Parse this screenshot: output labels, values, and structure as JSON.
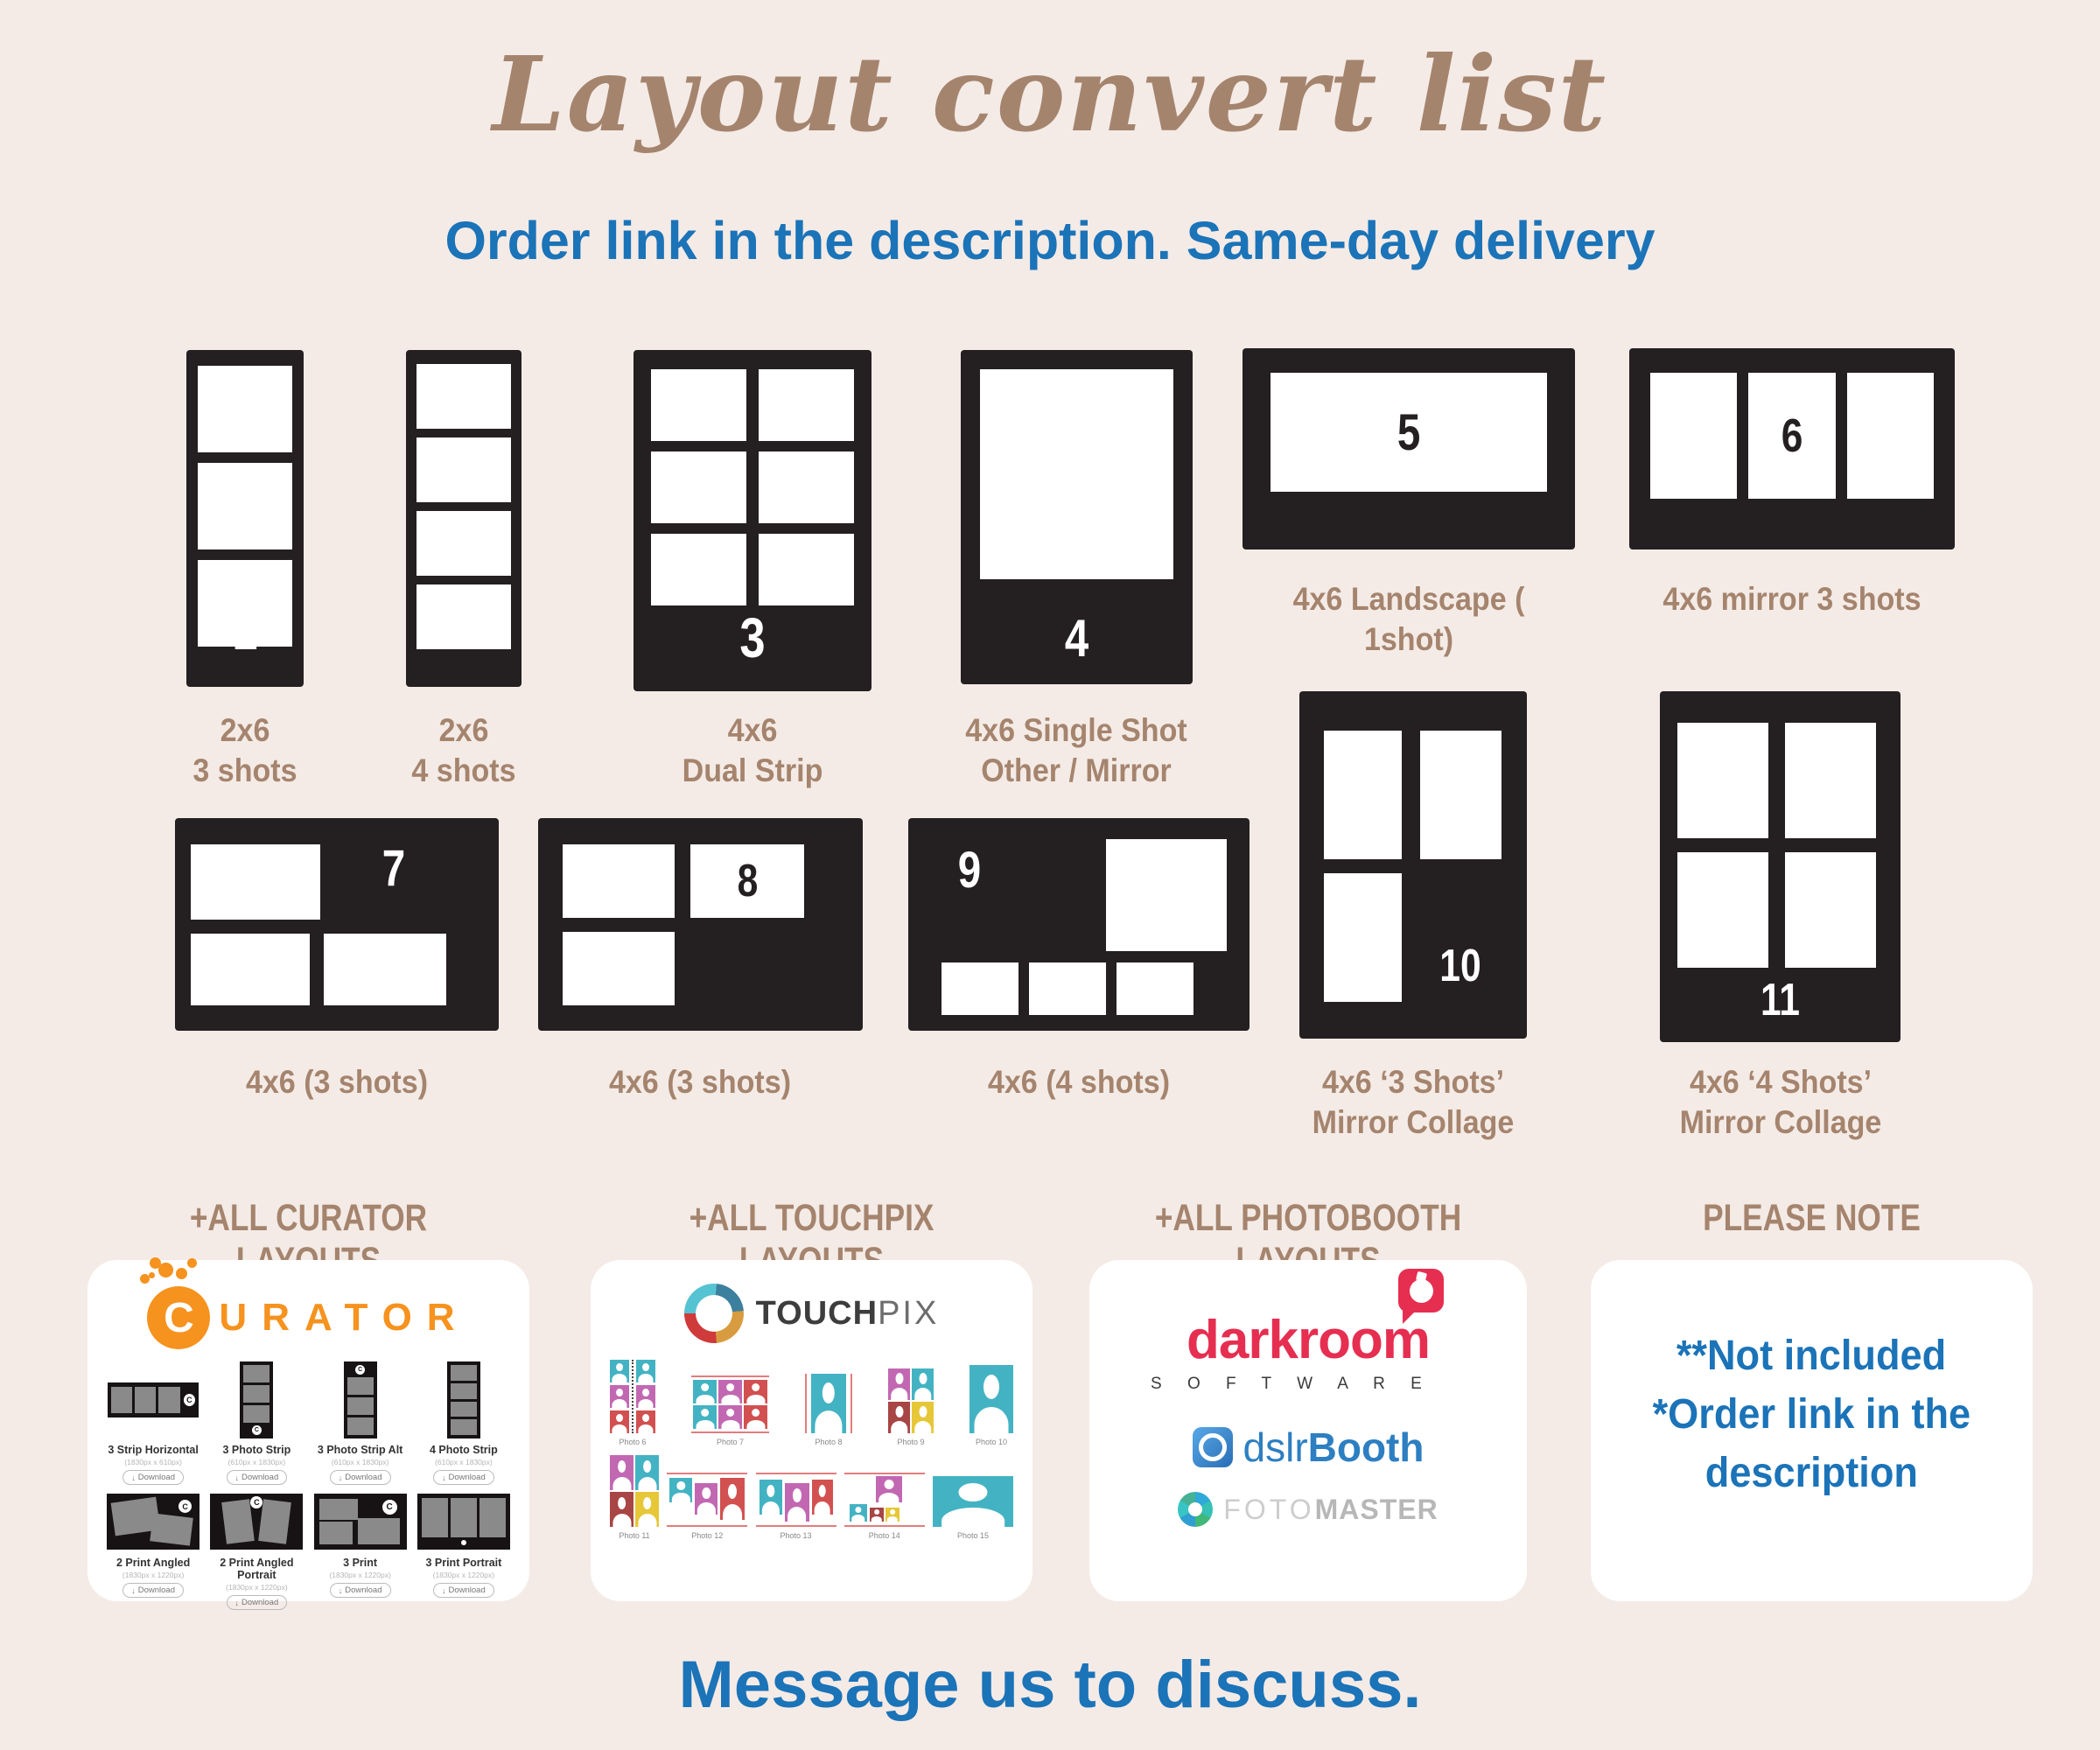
{
  "colors": {
    "background": "#f4ebe6",
    "card_dark": "#241f20",
    "brown": "#a5846e",
    "blue": "#1b73b8",
    "photo_gray": "#8a8a8a",
    "curator_orange": "#f6921e",
    "tp_teal": "#43b3c3",
    "tp_magenta": "#c268b2",
    "tp_red": "#d25050",
    "tp_dark_red": "#a84545",
    "tp_yellow": "#e6c737",
    "tp_ring_orange": "#d89b3f",
    "darkroom_red": "#e62e51",
    "dslr_blue": "#2d7fc1"
  },
  "header": {
    "title": "Layout convert list",
    "subtitle": "Order link in the description. Same-day delivery"
  },
  "layouts": [
    {
      "n": "1",
      "l1": "2x6",
      "l2": "3 shots"
    },
    {
      "n": "2",
      "l1": "2x6",
      "l2": "4 shots"
    },
    {
      "n": "3",
      "l1": "4x6",
      "l2": "Dual Strip"
    },
    {
      "n": "4",
      "l1": "4x6 Single Shot",
      "l2": "Other / Mirror"
    },
    {
      "n": "5",
      "l1": "4x6 Landscape ( 1shot)",
      "l2": ""
    },
    {
      "n": "6",
      "l1": "4x6 mirror 3 shots",
      "l2": ""
    },
    {
      "n": "7",
      "l1": "4x6 (3 shots)",
      "l2": ""
    },
    {
      "n": "8",
      "l1": "4x6 (3 shots)",
      "l2": ""
    },
    {
      "n": "9",
      "l1": "4x6 (4 shots)",
      "l2": ""
    },
    {
      "n": "10",
      "l1": "4x6 ‘3 Shots’",
      "l2": "Mirror Collage"
    },
    {
      "n": "11",
      "l1": "4x6 ‘4 Shots’",
      "l2": "Mirror Collage"
    }
  ],
  "bottom": {
    "headers": [
      "+ALL CURATOR LAYOUTS",
      "+ALL TOUCHPIX LAYOUTS",
      "+ALL PHOTOBOOTH LAYOUTS",
      "PLEASE NOTE"
    ],
    "curator": {
      "c": "C",
      "word": "URATOR",
      "items": [
        {
          "name": "3 Strip Horizontal",
          "dims": "(1830px x 610px)",
          "button": "Download"
        },
        {
          "name": "3 Photo Strip",
          "dims": "(610px x 1830px)",
          "button": "Download"
        },
        {
          "name": "3 Photo Strip Alt",
          "dims": "(610px x 1830px)",
          "button": "Download"
        },
        {
          "name": "4 Photo Strip",
          "dims": "(610px x 1830px)",
          "button": "Download"
        },
        {
          "name": "2 Print Angled",
          "dims": "(1830px x 1220px)",
          "button": "Download"
        },
        {
          "name": "2 Print Angled Portrait",
          "dims": "(1830px x 1220px)",
          "button": "Download"
        },
        {
          "name": "3 Print",
          "dims": "(1830px x 1220px)",
          "button": "Download"
        },
        {
          "name": "3 Print Portrait",
          "dims": "(1830px x 1220px)",
          "button": "Download"
        }
      ]
    },
    "touchpix": {
      "bold": "TOUCH",
      "light": "PIX",
      "captions": [
        "Photo 6",
        "Photo 7",
        "Photo 8",
        "Photo 9",
        "Photo 10",
        "Photo 11",
        "Photo 12",
        "Photo 13",
        "Photo 14",
        "Photo 15"
      ]
    },
    "photobooth": {
      "darkroom": "darkroom",
      "software": "S O F T W A R E",
      "dslr": "dslr",
      "booth": "Booth",
      "foto": "FOTO",
      "master": "MASTER"
    },
    "note_lines": [
      "**Not included",
      "*Order link in the",
      "description"
    ]
  },
  "footer": {
    "message": "Message us to discuss."
  }
}
